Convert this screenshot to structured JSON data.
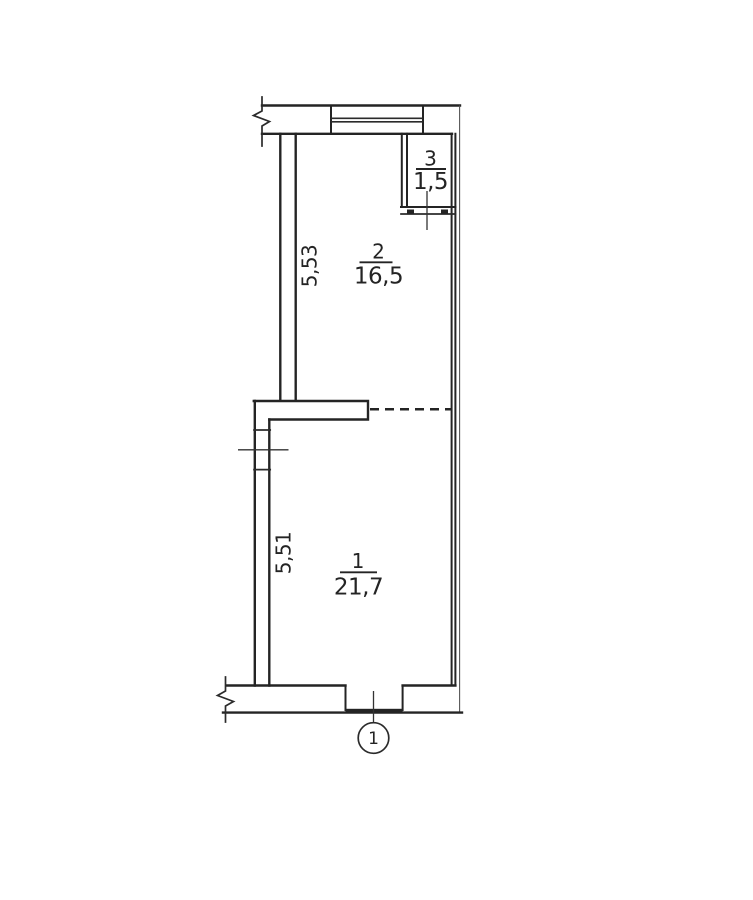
{
  "colors": {
    "ink": "#242424",
    "background": "#ffffff"
  },
  "plan": {
    "rooms": {
      "room1": {
        "number": "1",
        "area": "21,7",
        "height_dim": "5,51"
      },
      "room2": {
        "number": "2",
        "area": "16,5",
        "height_dim": "5,53"
      },
      "room3": {
        "number": "3",
        "area": "1,5"
      }
    },
    "entrance_marker": "1"
  }
}
